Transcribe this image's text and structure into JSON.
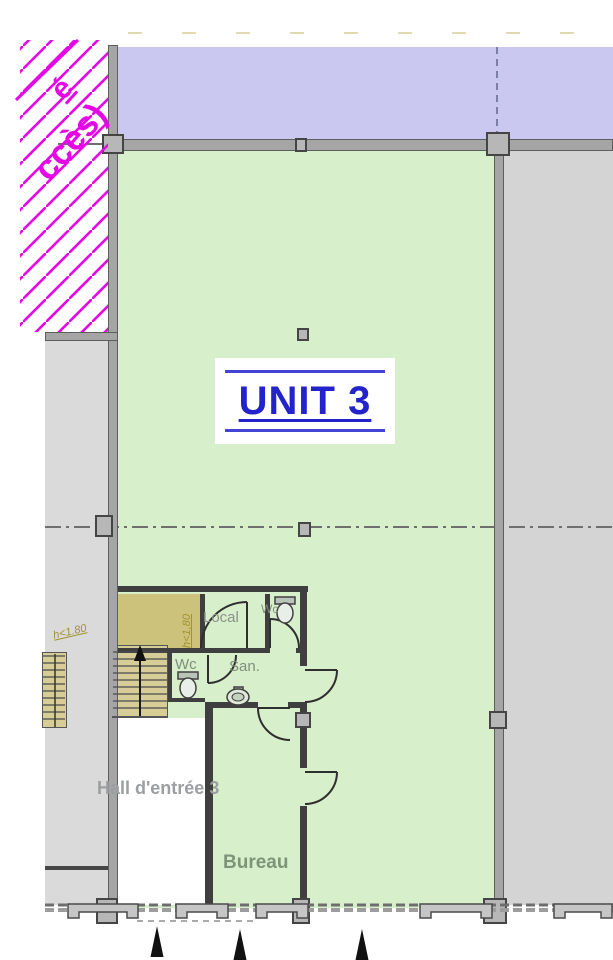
{
  "unit": {
    "label": "UNIT 3"
  },
  "rooms": {
    "local": "Local",
    "wc_upper": "Wc",
    "wc_lower": "Wc",
    "san": "San.",
    "hall": "Hall d'entrée 3",
    "bureau": "Bureau"
  },
  "annotations": {
    "access_fragment_line1": "é",
    "access_fragment_line2": "ccès)",
    "height_note_stairwell": "h<1,80",
    "height_note_left": "h<1.80"
  },
  "colors": {
    "unit_floor": "#d8efcb",
    "adjacent_unit_top": "#cac8f0",
    "adjacent_area_right": "#d4d4d4",
    "adjacent_area_left": "#dadada",
    "low_height_zone": "#cdc27c",
    "stairs": "#d6ce96",
    "access_hatch": "#e607e6",
    "unit_label_blue": "#2323cb",
    "wall_gray": "#a5a5a5"
  }
}
